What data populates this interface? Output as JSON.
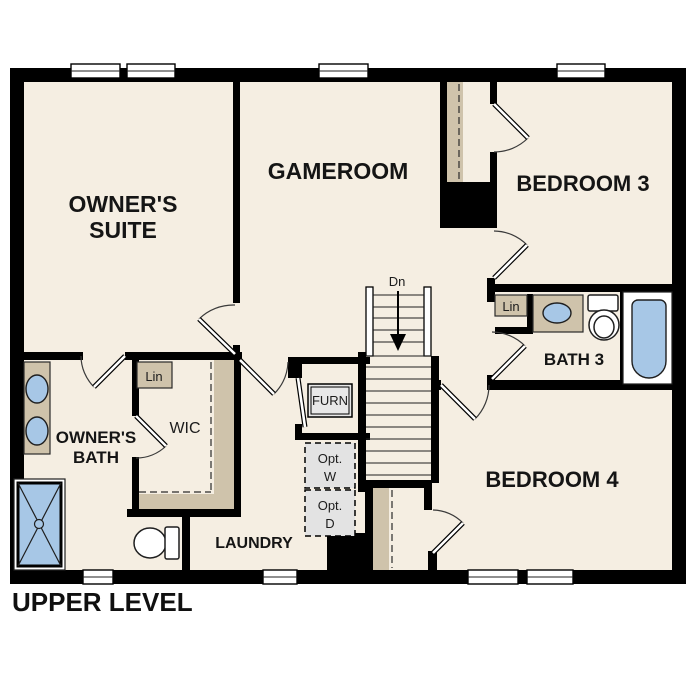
{
  "title": "UPPER LEVEL",
  "rooms": {
    "owners_suite": {
      "line1": "OWNER'S",
      "line2": "SUITE"
    },
    "gameroom": {
      "label": "GAMEROOM"
    },
    "bedroom3": {
      "label": "BEDROOM 3"
    },
    "bath3": {
      "label": "BATH 3"
    },
    "bedroom4": {
      "label": "BEDROOM 4"
    },
    "owners_bath": {
      "line1": "OWNER'S",
      "line2": "BATH"
    },
    "wic": {
      "label": "WIC"
    },
    "laundry": {
      "label": "LAUNDRY"
    }
  },
  "annotations": {
    "linen_wic": "Lin",
    "linen_bath3": "Lin",
    "furnace": "FURN",
    "optional_washer": {
      "line1": "Opt.",
      "line2": "W"
    },
    "optional_dryer": {
      "line1": "Opt.",
      "line2": "D"
    },
    "stairs_direction": "Dn"
  },
  "colors": {
    "wall": "#000000",
    "floor": "#f5eee2",
    "casework_tan": "#cfc3ab",
    "fixture_blue": "#a7c7e6",
    "optional_gray": "#e3e3e3",
    "background": "#ffffff"
  }
}
